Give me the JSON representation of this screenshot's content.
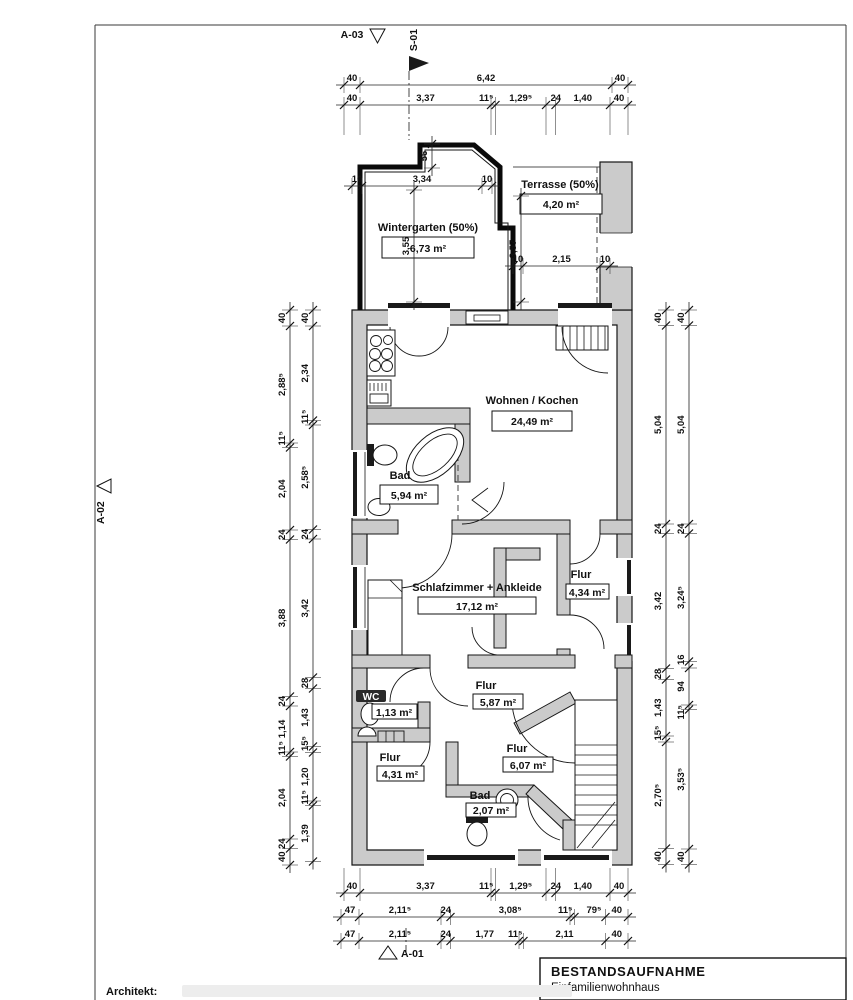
{
  "page": {
    "architect_label": "Architekt:"
  },
  "title_block": {
    "title": "BESTANDSAUFNAHME",
    "subtitle": "Einfamilienwohnhaus"
  },
  "markers": {
    "a03": "A-03",
    "s01": "S-01",
    "a02": "A-02",
    "a01": "A-01"
  },
  "rooms": [
    {
      "name": "Wintergarten (50%)",
      "area": "6,73 m²"
    },
    {
      "name": "Terrasse (50%)",
      "area": "4,20 m²"
    },
    {
      "name": "Wohnen / Kochen",
      "area": "24,49 m²"
    },
    {
      "name": "Bad",
      "area": "5,94 m²"
    },
    {
      "name": "Schlafzimmer + Ankleide",
      "area": "17,12 m²"
    },
    {
      "name": "Flur",
      "area": "4,34 m²"
    },
    {
      "name": "Flur",
      "area": "5,87 m²"
    },
    {
      "name": "WC",
      "area": "1,13 m²"
    },
    {
      "name": "Flur",
      "area": "4,31 m²"
    },
    {
      "name": "Flur",
      "area": "6,07 m²"
    },
    {
      "name": "Bad",
      "area": "2,07 m²"
    }
  ],
  "dims": {
    "top_row1": [
      "40",
      "6,42",
      "40"
    ],
    "top_row2": [
      "40",
      "3,37",
      "11⁵",
      "1,29⁵",
      "24",
      "1,40",
      "40"
    ],
    "bottom_row1": [
      "40",
      "3,37",
      "11⁵",
      "1,29⁵",
      "24",
      "1,40",
      "40"
    ],
    "bottom_row2": [
      "47",
      "2,11⁵",
      "24",
      "3,08⁵",
      "11⁵",
      "79⁵",
      "40"
    ],
    "bottom_row3": [
      "47",
      "2,11⁵",
      "24",
      "1,77",
      "11⁵",
      "2,11",
      "40"
    ],
    "left_outer": [
      "40",
      "2,88⁵",
      "11⁵",
      "2,04",
      "24",
      "3,88",
      "24",
      "1,14",
      "11⁵",
      "2,04",
      "24",
      "40"
    ],
    "left_inner": [
      "40",
      "2,34",
      "11⁵",
      "2,58⁵",
      "24",
      "3,42",
      "28",
      "1,43",
      "15⁵",
      "1,20",
      "11⁵",
      "1,39"
    ],
    "right_inner": [
      "40",
      "5,04",
      "24",
      "3,42",
      "28",
      "1,43",
      "15⁵",
      "2,70⁵",
      "40"
    ],
    "right_outer": [
      "40",
      "5,04",
      "24",
      "3,24⁵",
      "16",
      "94",
      "11⁵",
      "3,53⁵",
      "40"
    ],
    "wg_width": [
      "10",
      "3,34",
      "10"
    ],
    "terr_width": [
      "10",
      "2,15",
      "10"
    ],
    "wg_height": [
      "3,55"
    ],
    "terr_height": [
      "3,57"
    ],
    "bump": [
      "56"
    ]
  }
}
